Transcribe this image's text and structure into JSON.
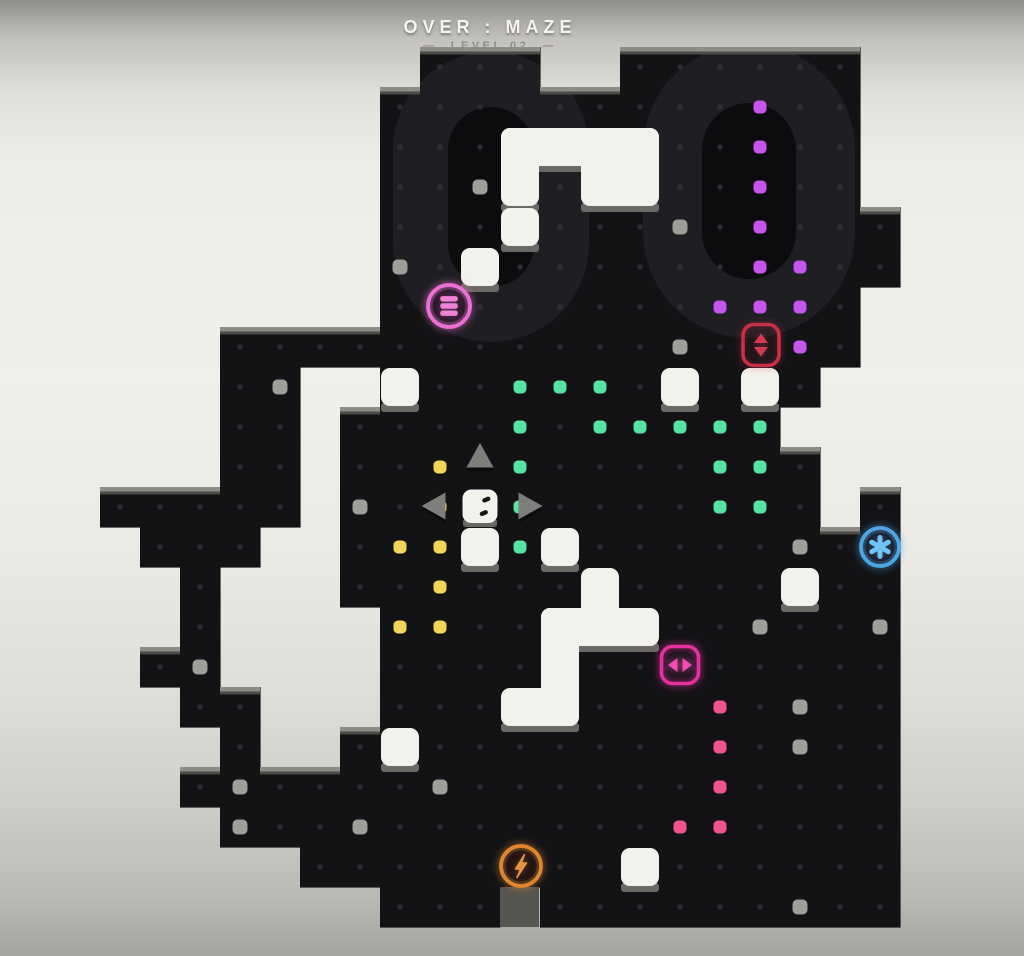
{
  "hud": {
    "title": "OVER : MAZE",
    "level": "—  LEVEL 02  —"
  },
  "watermark": {
    "text": "00"
  },
  "colors": {
    "floor": "#131316",
    "watermark_ring": "#1e1e23",
    "watermark_hole": "#0c0c0f",
    "grid_dot": "#2f2f33",
    "edge_shadow": "#8e8c87",
    "edge_shadow_dark": "#4b4a46",
    "block_white": "#f3f1ec",
    "block_shadow": "#6b6965",
    "notch_gray": "#57554f",
    "pellet_green": "#58e2a2",
    "pellet_yellow": "#f1d558",
    "pellet_purple": "#c855ea",
    "pellet_pink": "#f0548e",
    "button_gray": "#a09e98",
    "player_white": "#f4f2ec",
    "player_eye": "#17171a",
    "arrow_gray": "#7e7e7a",
    "title_white": "#f6f4ef",
    "subtitle_gray": "#8f8d89"
  },
  "grid": {
    "cell": 40,
    "left": 20,
    "top": 47,
    "cols": 26,
    "rows": 22
  },
  "maze_rows": [
    "..........###..######.....",
    ".........############.....",
    ".........############.....",
    ".........############.....",
    ".........#############....",
    ".........#############....",
    ".........############.....",
    ".....################.....",
    ".....##..###########......",
    ".....##.###########.......",
    ".....##.############......",
    "..#####.############.#....",
    "...###..##############....",
    "....#...##############....",
    "....#....#############....",
    "...##....#############....",
    "....##...#############....",
    ".....#..##############....",
    "....##################....",
    ".....#################....",
    ".......###############....",
    ".........###.#########...."
  ],
  "pellets": {
    "green": [
      [
        12,
        8
      ],
      [
        13,
        8
      ],
      [
        14,
        8
      ],
      [
        12,
        9
      ],
      [
        14,
        9
      ],
      [
        15,
        9
      ],
      [
        16,
        9
      ],
      [
        17,
        9
      ],
      [
        18,
        9
      ],
      [
        12,
        10
      ],
      [
        17,
        10
      ],
      [
        18,
        10
      ],
      [
        12,
        11
      ],
      [
        17,
        11
      ],
      [
        18,
        11
      ],
      [
        12,
        12
      ]
    ],
    "yellow": [
      [
        10,
        10
      ],
      [
        10,
        11
      ],
      [
        9,
        12
      ],
      [
        10,
        12
      ],
      [
        10,
        13
      ],
      [
        9,
        14
      ],
      [
        10,
        14
      ]
    ],
    "purple": [
      [
        18,
        1
      ],
      [
        18,
        2
      ],
      [
        18,
        3
      ],
      [
        18,
        4
      ],
      [
        18,
        5
      ],
      [
        19,
        5
      ],
      [
        17,
        6
      ],
      [
        18,
        6
      ],
      [
        19,
        6
      ],
      [
        19,
        7
      ]
    ],
    "pink": [
      [
        17,
        16
      ],
      [
        17,
        17
      ],
      [
        17,
        18
      ],
      [
        16,
        19
      ],
      [
        17,
        19
      ]
    ]
  },
  "buttons": [
    [
      11,
      3
    ],
    [
      16,
      4
    ],
    [
      9,
      5
    ],
    [
      16,
      7
    ],
    [
      6,
      8
    ],
    [
      8,
      11
    ],
    [
      19,
      12
    ],
    [
      18,
      14
    ],
    [
      21,
      14
    ],
    [
      4,
      15
    ],
    [
      19,
      16
    ],
    [
      19,
      17
    ],
    [
      5,
      18
    ],
    [
      10,
      18
    ],
    [
      5,
      19
    ],
    [
      8,
      19
    ],
    [
      19,
      21
    ]
  ],
  "blocks": [
    [
      [
        501,
        128,
        158,
        38
      ],
      [
        501,
        128,
        38,
        78
      ],
      [
        581,
        128,
        78,
        78
      ]
    ],
    [
      [
        501,
        208,
        38,
        38
      ]
    ],
    [
      [
        461,
        248,
        38,
        38
      ]
    ],
    [
      [
        381,
        368,
        38,
        38
      ]
    ],
    [
      [
        661,
        368,
        38,
        38
      ]
    ],
    [
      [
        741,
        368,
        38,
        38
      ]
    ],
    [
      [
        461,
        528,
        38,
        38
      ]
    ],
    [
      [
        541,
        528,
        38,
        38
      ]
    ],
    [
      [
        581,
        568,
        38,
        78
      ],
      [
        541,
        608,
        118,
        38
      ],
      [
        541,
        608,
        38,
        118
      ],
      [
        501,
        688,
        78,
        38
      ]
    ],
    [
      [
        381,
        728,
        38,
        38
      ]
    ],
    [
      [
        781,
        568,
        38,
        38
      ]
    ],
    [
      [
        621,
        848,
        38,
        38
      ]
    ]
  ],
  "notch": [
    501,
    887,
    38,
    40
  ],
  "player": {
    "x": 480,
    "y": 506
  },
  "arrows": [
    {
      "dir": "up",
      "x": 480,
      "y": 455
    },
    {
      "dir": "left",
      "x": 434,
      "y": 506
    },
    {
      "dir": "right",
      "x": 530,
      "y": 506
    }
  ],
  "icons": [
    {
      "name": "menu-icon",
      "shape": "circle",
      "glyph": "bars",
      "color": "#ec6fd2",
      "glyph_color": "#ef84d6",
      "x": 449,
      "y": 306,
      "r": 21,
      "glow": 0.9
    },
    {
      "name": "vertical-arrows-icon",
      "shape": "square",
      "glyph": "updown",
      "color": "#c92f45",
      "glyph_color": "#d43b50",
      "x": 761,
      "y": 345,
      "w": 36,
      "h": 41,
      "glow": 0.55
    },
    {
      "name": "asterisk-icon",
      "shape": "circle",
      "glyph": "asterisk",
      "color": "#4fa6e4",
      "glyph_color": "#6fc3f4",
      "x": 880,
      "y": 547,
      "r": 19,
      "glow": 0.85
    },
    {
      "name": "horizontal-arrows-icon",
      "shape": "square",
      "glyph": "leftright",
      "color": "#e6309f",
      "glyph_color": "#f04bb0",
      "x": 680,
      "y": 665,
      "w": 37,
      "h": 37,
      "glow": 0.9
    },
    {
      "name": "lightning-icon",
      "shape": "circle",
      "glyph": "bolt",
      "color": "#df862f",
      "glyph_color": "#e89440",
      "x": 521,
      "y": 866,
      "r": 20,
      "glow": 0.85
    }
  ]
}
